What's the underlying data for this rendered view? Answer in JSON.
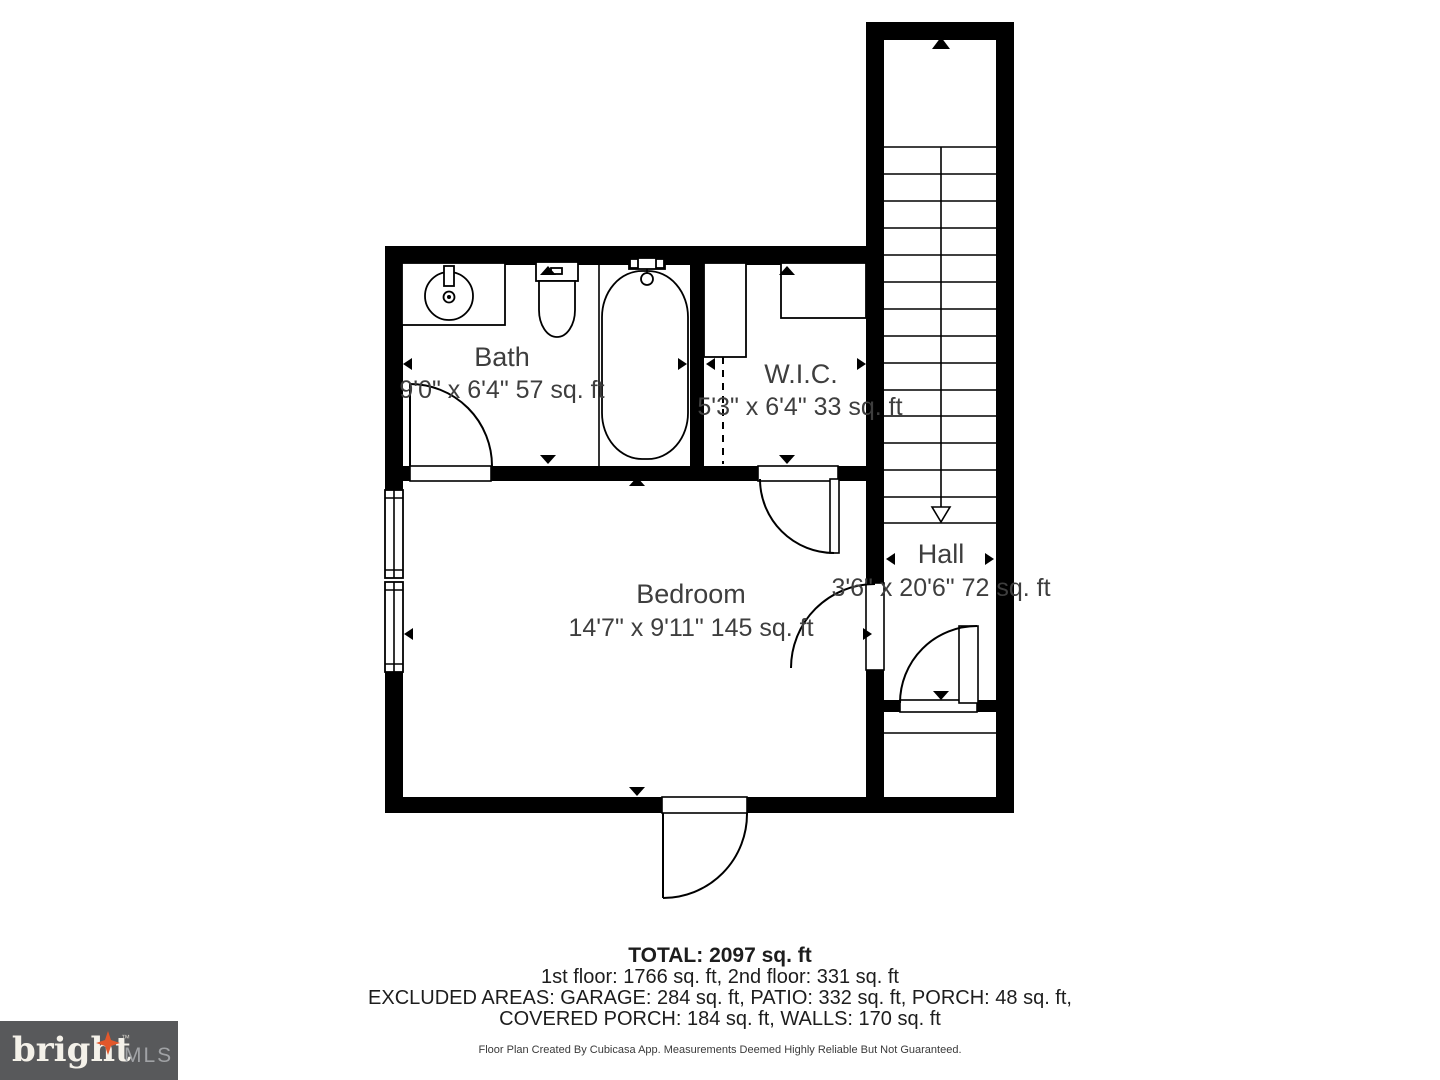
{
  "floor_plan": {
    "rooms": [
      {
        "name": "Bath",
        "dimensions": "9'0\" x 6'4\" 57 sq. ft"
      },
      {
        "name": "W.I.C.",
        "dimensions": "5'3\" x 6'4\" 33 sq. ft"
      },
      {
        "name": "Bedroom",
        "dimensions": "14'7\" x 9'11\" 145 sq. ft"
      },
      {
        "name": "Hall",
        "dimensions": "3'6\" x 20'6\" 72 sq. ft"
      }
    ],
    "colors": {
      "walls": "#000000",
      "room_label": "#3e3e3e",
      "background": "#ffffff"
    }
  },
  "summary": {
    "total": "TOTAL: 2097 sq. ft",
    "floor_breakdown": "1st floor: 1766 sq. ft, 2nd floor: 331 sq. ft",
    "excluded_line1": "EXCLUDED AREAS: GARAGE: 284 sq. ft, PATIO: 332 sq. ft, PORCH: 48 sq. ft,",
    "excluded_line2": "COVERED PORCH: 184 sq. ft, WALLS: 170 sq. ft",
    "disclaimer": "Floor Plan Created By Cubicasa App. Measurements Deemed Highly Reliable But Not Guaranteed."
  },
  "logo": {
    "brand": "bright",
    "trademark": "TM",
    "suffix": "MLS",
    "colors": {
      "background": "#58595b",
      "brand_text": "#f4f1e9",
      "suffix_text": "#a0a2a5",
      "star": "#e2572b"
    }
  }
}
